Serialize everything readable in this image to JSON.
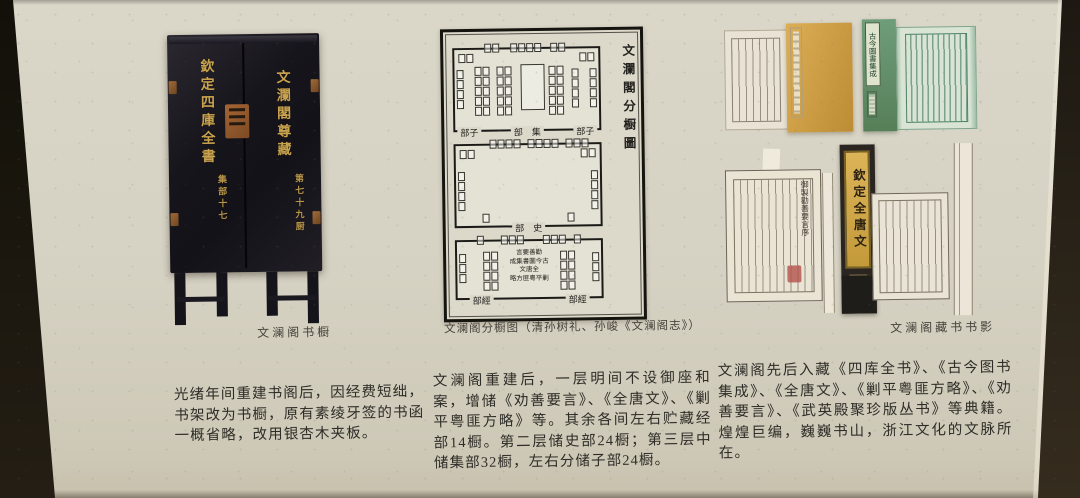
{
  "colors": {
    "background": "#d6d2c3",
    "edge_dark": "#17150f",
    "cabinet_body": "#17151c",
    "gold_text": "#c8a24e",
    "brass": "#95602f",
    "diagram_ink": "#1b1a17",
    "yellow_cover": "#d0a24c",
    "green_cover": "#649169",
    "green_print_ink": "#3f7d62",
    "spine_gold": "#c9a23c",
    "seal_red": "#b3554a",
    "body_text": "#2e2c27"
  },
  "cabinet": {
    "left_door_title": "欽定四庫全書",
    "left_door_sub": "集部十七",
    "right_door_title": "文瀾閣尊藏",
    "right_door_sub": "第七十九厨"
  },
  "diagram": {
    "title": "文瀾閣分橱圖",
    "room_ji": {
      "label_left": "部子",
      "label_center": "部　集",
      "label_right": "部子"
    },
    "room_shi": {
      "label_center": "部　史"
    },
    "room_jing": {
      "label_left": "部經",
      "label_right": "部經",
      "lines": [
        "言要善勸",
        "成集書圖今古",
        "文唐全",
        "略方匪粵平剿"
      ]
    }
  },
  "books": {
    "green_cover_label": "古今圖書集成",
    "spine_label": "欽定全唐文",
    "page_header": "御製勸善要言序"
  },
  "captions": {
    "cabinet": "文澜阁书橱",
    "diagram": "文澜阁分橱图（清孙树礼、孙峻《文澜阁志》）",
    "books": "文澜阁藏书书影"
  },
  "paragraphs": {
    "left": "光绪年间重建书阁后，因经费短绌，书架改为书橱，原有素绫牙签的书函一概省略，改用银杏木夹板。",
    "center": "文澜阁重建后，一层明间不设御座和案，增储《劝善要言》、《全唐文》、《剿平粤匪方略》等。其余各间左右贮藏经部14橱。第二层储史部24橱；第三层中储集部32橱，左右分储子部24橱。",
    "right": "文澜阁先后入藏《四库全书》、《古今图书集成》、《全唐文》、《剿平粤匪方略》、《劝善要言》、《武英殿聚珍版丛书》等典籍。煌煌巨编，巍巍书山，浙江文化的文脉所在。"
  }
}
